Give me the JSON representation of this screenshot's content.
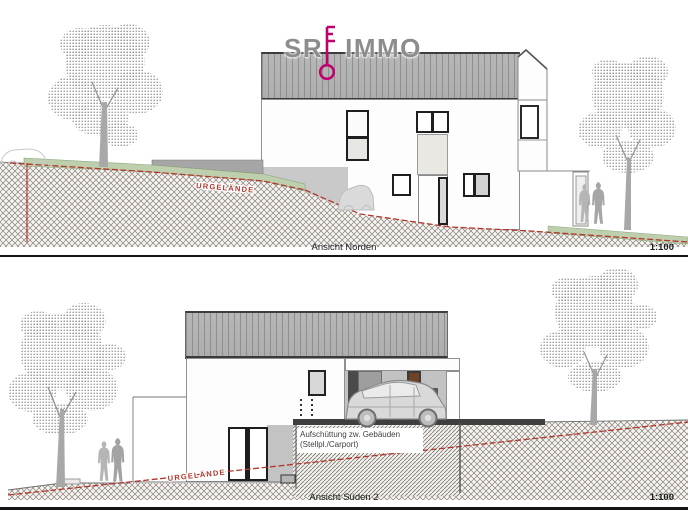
{
  "logo": {
    "sr": "SR",
    "immo": "IMMO"
  },
  "views": [
    {
      "label": "Ansicht Norden",
      "scale": "1:100",
      "terrain_label": "URGELÄNDE"
    },
    {
      "label": "Ansicht Süden 2",
      "scale": "1:100",
      "terrain_label": "URGELÄNDE",
      "annotation": {
        "line1": "Aufschüttung zw. Gebäuden",
        "line2": "(Stellpl./Carport)"
      }
    }
  ],
  "colors": {
    "roof_fill": "#b5b5b5",
    "roof_stripe": "#8f8f8f",
    "terrain_green": "#bdcfac",
    "terrain_red_line": "#b0372e",
    "logo_gray": "#8d8d8d",
    "logo_key_magenta": "#c0006e",
    "door_brown": "#6e4426",
    "ground_hatch": "#8a857e"
  }
}
